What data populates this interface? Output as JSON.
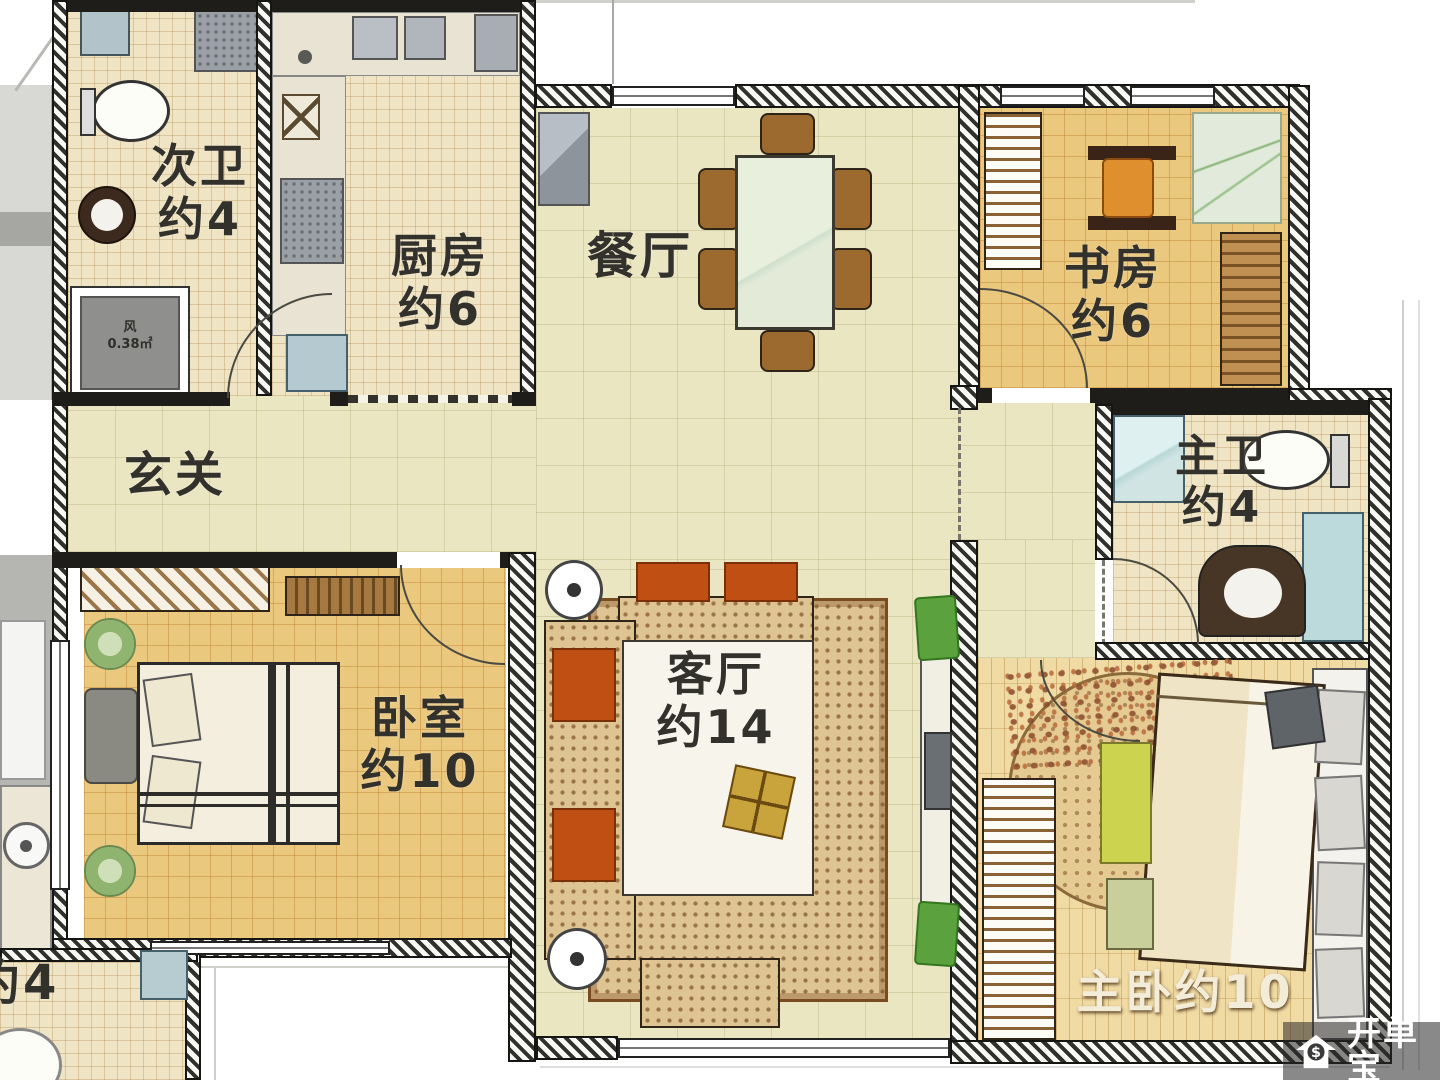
{
  "palette": {
    "wall_dark": "#1f1d1a",
    "floor_cream": "#eae6c2",
    "floor_tile": "#efe4c3",
    "floor_wood": "#eac87e",
    "floor_stripe": "#f1dba4",
    "sofa_orange": "#bf4f12",
    "chair_brown": "#9c6a2e",
    "plant_green": "#5ba23e",
    "water_blue": "#bcd9dc",
    "label_dark": "#33312c",
    "label_light": "#f3ecd9",
    "watermark_bg": "rgba(40,40,40,0.55)"
  },
  "rooms": {
    "bath2": {
      "name": "次卫",
      "area": "约4"
    },
    "kitchen": {
      "name": "厨房",
      "area": "约6"
    },
    "dining": {
      "name": "餐厅"
    },
    "study": {
      "name": "书房",
      "area": "约6"
    },
    "foyer": {
      "name": "玄关"
    },
    "master_bath": {
      "name": "主卫",
      "area": "约4"
    },
    "bedroom": {
      "name": "卧室",
      "area": "约10"
    },
    "living": {
      "name": "客厅",
      "area": "约14"
    },
    "master_bedroom": {
      "name": "主卧约10"
    },
    "partial_room": {
      "name": "约4"
    }
  },
  "shaft": {
    "name": "风",
    "area_value": "0.38㎡"
  },
  "watermark": {
    "brand": "开单宝",
    "icon": "house-dollar-icon"
  }
}
